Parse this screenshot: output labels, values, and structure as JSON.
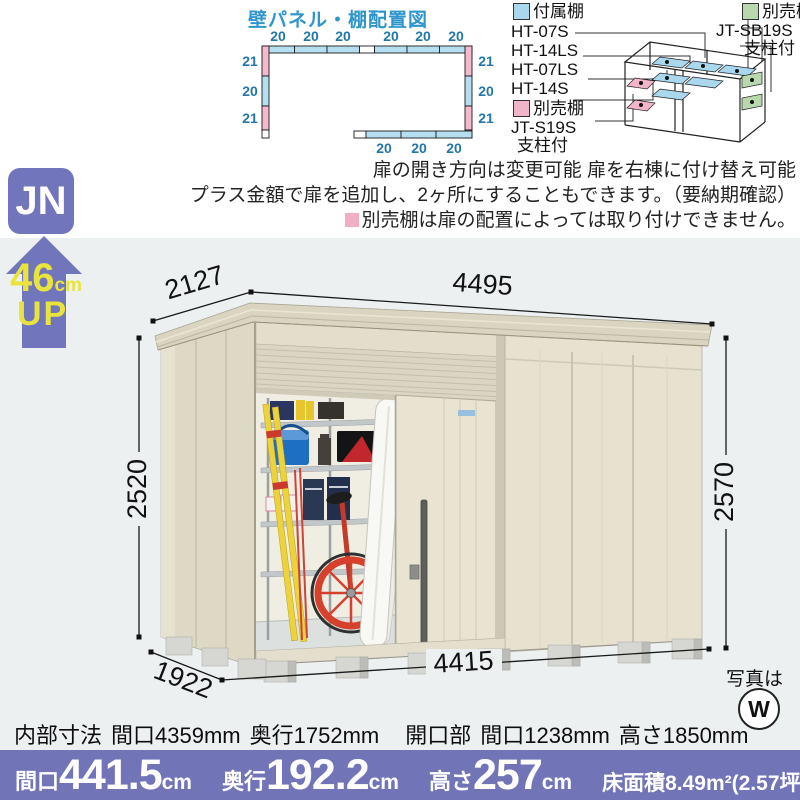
{
  "diagram": {
    "title": "壁パネル・棚配置図",
    "top_labels": [
      "20",
      "20",
      "20",
      "20",
      "20",
      "20"
    ],
    "left_labels": [
      "21",
      "20",
      "21"
    ],
    "right_labels": [
      "21",
      "20",
      "21"
    ],
    "bottom_labels": [
      "20",
      "20",
      "20"
    ],
    "blue": "#b5def1",
    "pink": "#f5b9cd"
  },
  "legend": {
    "attached_label": "付属棚",
    "attached_models": [
      "HT-07S",
      "HT-14LS",
      "HT-07LS",
      "HT-14S"
    ],
    "pink_label": "別売棚",
    "pink_model": "JT-S19S",
    "pink_note": "支柱付",
    "green_label": "別売棚",
    "green_model": "JT-SB19S",
    "green_note": "支柱付",
    "attached_color": "#a9d7ee",
    "pink_color": "#f2b4c8",
    "green_color": "#b9d8ae"
  },
  "notes": {
    "line1": "扉の開き方向は変更可能 扉を右棟に付け替え可能",
    "line2": "プラス金額で扉を追加し、2ヶ所にすることもできます。（要納期確認）",
    "line3": "別売棚は扉の配置によっては取り付けできません。"
  },
  "badge": {
    "series": "JN",
    "up_value": "46",
    "up_unit": "cm",
    "up_word": "UP",
    "color": "#7175bc"
  },
  "dims": {
    "top_depth": "2127",
    "top_width": "4495",
    "left_height": "2520",
    "right_height": "2570",
    "bottom_width": "4415",
    "bottom_depth": "1922"
  },
  "photo": {
    "label": "写真は",
    "mark": "W"
  },
  "specs": {
    "internal_label": "内部寸法",
    "internal_width": "間口4359mm",
    "internal_depth": "奥行1752mm",
    "opening_label": "開口部",
    "opening_width": "間口1238mm",
    "opening_height": "高さ1850mm"
  },
  "bar": {
    "bg": "#7175b7",
    "items": [
      {
        "label": "間口",
        "value": "441.5",
        "unit": "cm"
      },
      {
        "label": "奥行",
        "value": "192.2",
        "unit": "cm"
      },
      {
        "label": "高さ",
        "value": "257",
        "unit": "cm"
      }
    ],
    "area": "床面積8.49m²(2.57坪)"
  }
}
